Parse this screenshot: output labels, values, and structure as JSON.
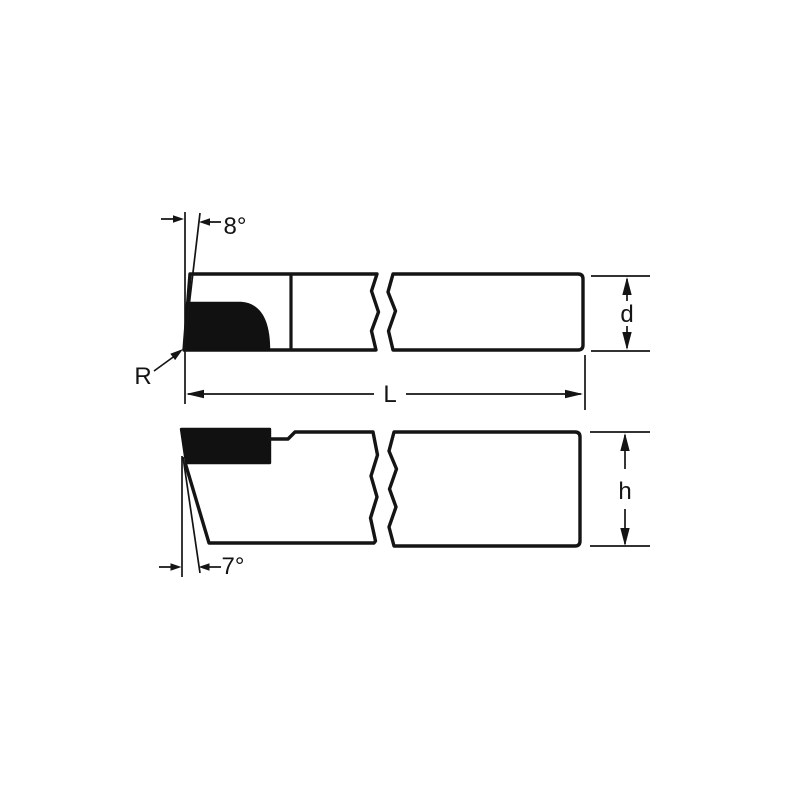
{
  "canvas": {
    "background": "#ffffff",
    "ink": "#141414",
    "insert_fill": "#111111"
  },
  "diagram": {
    "labels": {
      "top_angle": "8°",
      "nose_radius": "R",
      "overall_length": "L",
      "shank_width": "d",
      "shank_height": "h",
      "front_clearance_angle": "7°"
    }
  }
}
